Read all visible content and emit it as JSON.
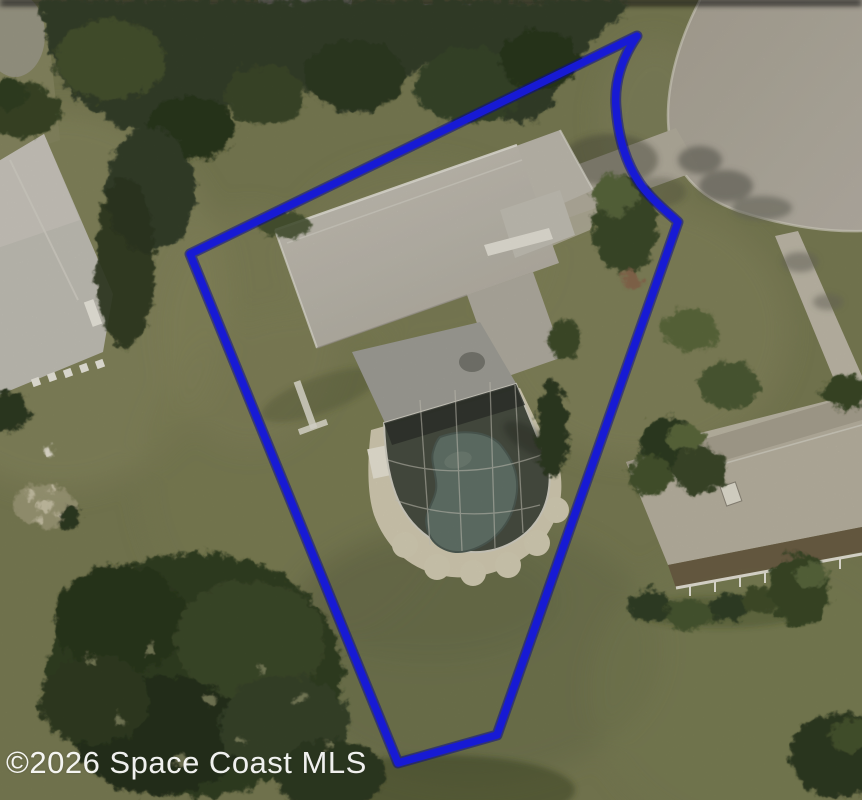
{
  "watermark": {
    "text": "©2026 Space Coast MLS",
    "color": "#ffffff"
  },
  "boundary": {
    "color": "#171ad4",
    "underlay_color": "#0a0b8a",
    "stroke_width": 7.5,
    "underlay_width": 11,
    "path": "M 637 36 C 622 58 614 82 616 107 C 618 136 626 166 644 189 C 658 206 670 214 678 222 L 497 735 L 398 763 L 190 254 Z"
  },
  "scene": {
    "kind": "aerial-property-photo",
    "features": [
      "main-house-roof",
      "screened-pool-enclosure",
      "swimming-pool",
      "pool-deck",
      "driveway",
      "cul-de-sac",
      "sidewalk",
      "left-neighbor-house",
      "right-neighbor-house",
      "tree-canopy",
      "lawn",
      "shed"
    ]
  },
  "palette": {
    "grass": "#7c7e55",
    "grass_dark": "#6a6e49",
    "grass_light": "#8c8c63",
    "pavement": "#b4aea2",
    "roof_light": "#c6c2b7",
    "roof_right_house": "#bdb6a4",
    "porch_brown": "#6e5f46",
    "pool_water": "#64746a",
    "enclosure_screen": "#3e4339",
    "sand_deck": "#d7d0b6",
    "tree_dark": "#2c381f"
  }
}
